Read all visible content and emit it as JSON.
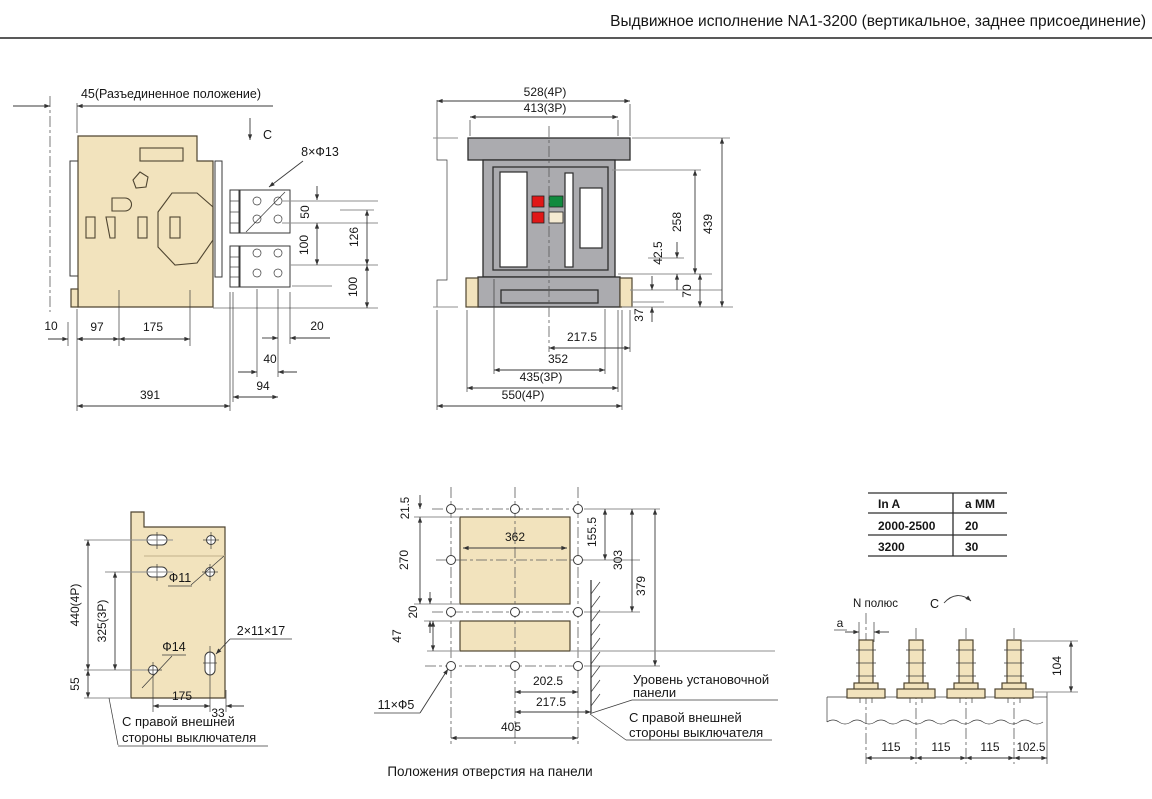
{
  "title": "Выдвижное исполнение NA1-3200 (вертикальное, заднее присоединение)",
  "colors": {
    "paper": "#ffffff",
    "beige": "#f2e3bd",
    "gray": "#ababaf",
    "red": "#e01717",
    "green": "#108a3e",
    "cream": "#f4ead2"
  },
  "side_view": {
    "disconnected_position": "45(Разъединенное положение)",
    "section_mark": "C",
    "holes_callout": "8×Ф13",
    "dim_50": "50",
    "dim_126": "126",
    "dim_100a": "100",
    "dim_100b": "100",
    "dim_10": "10",
    "dim_97": "97",
    "dim_175": "175",
    "dim_20": "20",
    "dim_40": "40",
    "dim_94": "94",
    "dim_391": "391"
  },
  "front_view": {
    "dim_528": "528(4P)",
    "dim_413": "413(3P)",
    "dim_258": "258",
    "dim_439": "439",
    "dim_42_5": "42.5",
    "dim_70": "70",
    "dim_37": "37",
    "dim_217_5": "217.5",
    "dim_352": "352",
    "dim_435": "435(3P)",
    "dim_550": "550(4P)"
  },
  "right_plate": {
    "dim_440": "440(4P)",
    "dim_325": "325(3P)",
    "dim_55": "55",
    "hole_f11": "Ф11",
    "hole_f14": "Ф14",
    "slot_callout": "2×11×17",
    "dim_175": "175",
    "dim_33": "33",
    "note_line1": "С правой внешней",
    "note_line2": "стороны выключателя"
  },
  "panel_holes": {
    "dim_21_5": "21.5",
    "dim_270": "270",
    "dim_20": "20",
    "dim_47": "47",
    "dim_362": "362",
    "dim_155_5": "155.5",
    "dim_303": "303",
    "dim_379": "379",
    "dim_202_5": "202.5",
    "dim_217_5": "217.5",
    "dim_405": "405",
    "holes_callout": "11×Ф5",
    "level_note_line1": "Уровень  установочной",
    "level_note_line2": "панели",
    "side_note_line1": "С правой внешней",
    "side_note_line2": "стороны выключателя",
    "caption": "Положения отверстия на панели"
  },
  "selection": {
    "table": {
      "headers": [
        "In  A",
        "a MM"
      ],
      "rows": [
        [
          "2000-2500",
          "20"
        ],
        [
          "3200",
          "30"
        ]
      ]
    },
    "pole_label": "N полюс",
    "section_mark": "C",
    "a_label": "a",
    "dim_104": "104",
    "segs": [
      "115",
      "115",
      "115",
      "102.5"
    ]
  }
}
